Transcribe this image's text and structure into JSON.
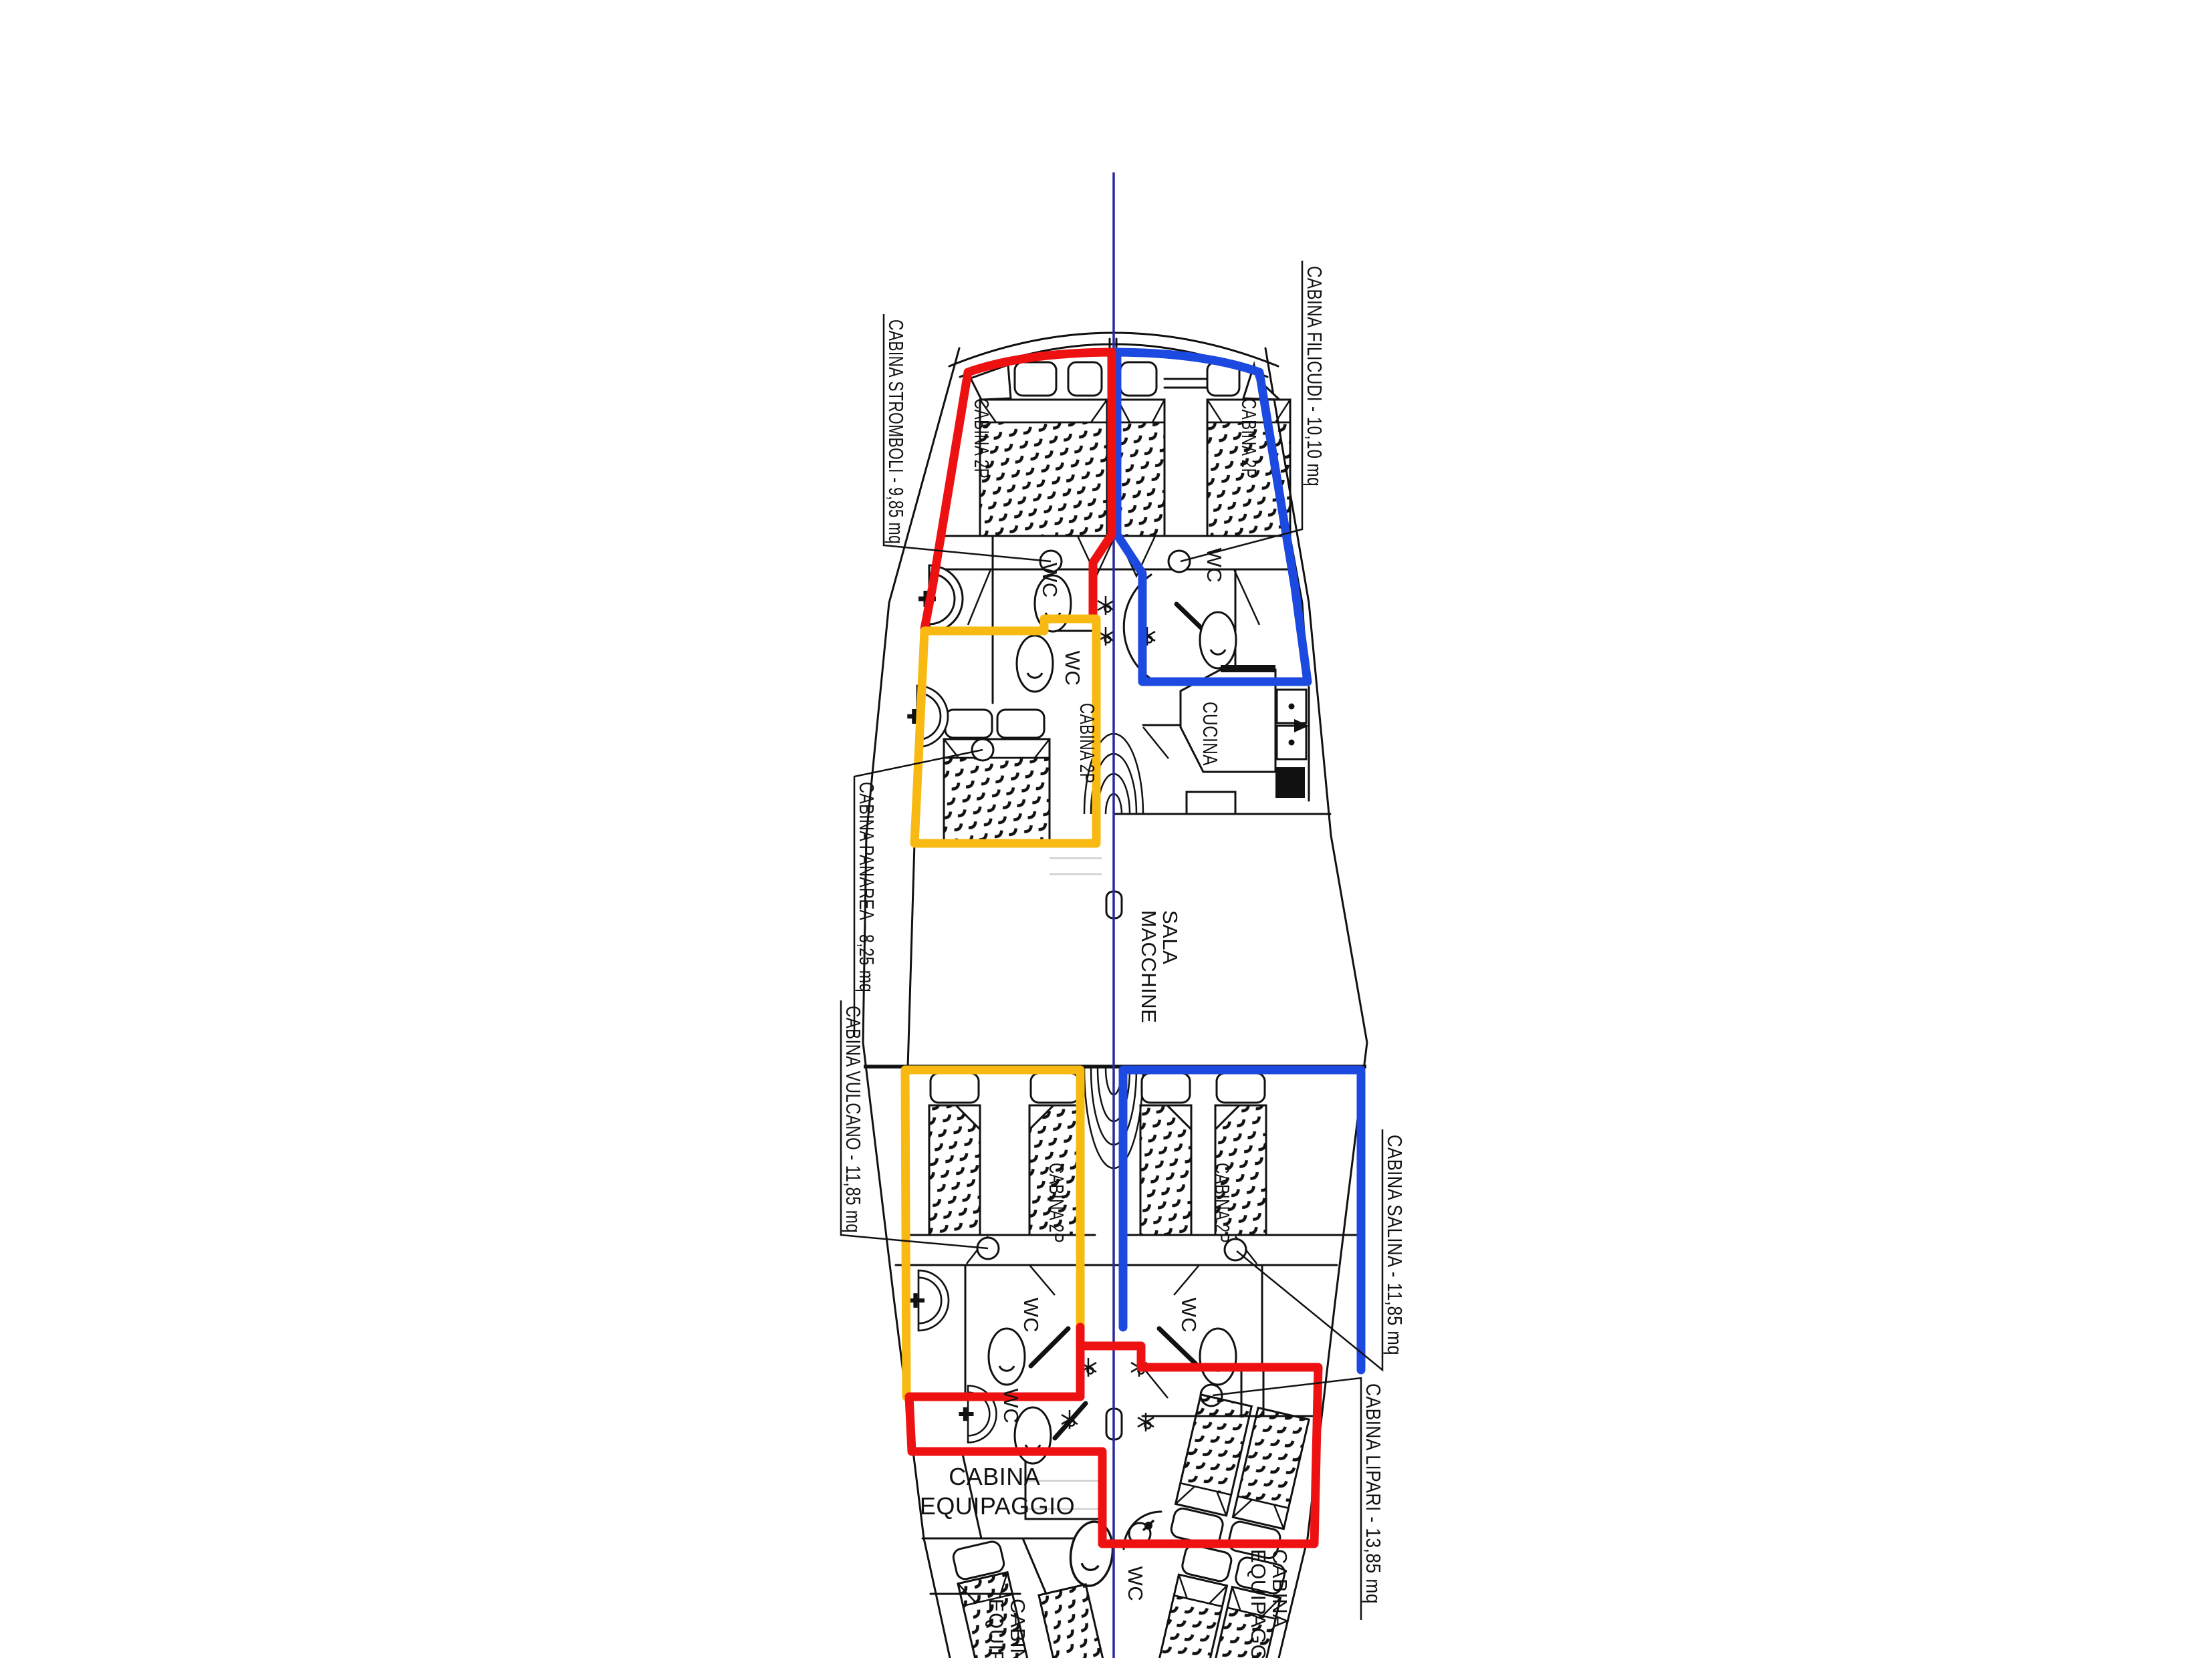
{
  "plan": {
    "callouts": {
      "stromboli": "CABINA STROMBOLI - 9,85 mq",
      "filicudi": "CABINA FILICUDI - 10,10 mq",
      "panarea": "CABINA PANAREA - 8,25 mq",
      "vulcano": "CABINA VULCANO - 11,85 mq",
      "salina": "CABINA SALINA - 11,85 mq",
      "lipari": "CABINA LIPARI - 13,85 mq"
    },
    "rooms": {
      "cabin2p": "CABINA 2P",
      "wc": "WC",
      "cucina": "CUCINA",
      "sala1": "SALA",
      "sala2": "MACCHINE",
      "equip1": "CABINA",
      "equip2": "EQUIPAGGIO"
    },
    "colors": {
      "outline_red": "#ee1111",
      "outline_blue": "#1c49e0",
      "outline_yellow": "#f8b912",
      "centerline": "#2b2b96",
      "ink": "#111111"
    }
  }
}
